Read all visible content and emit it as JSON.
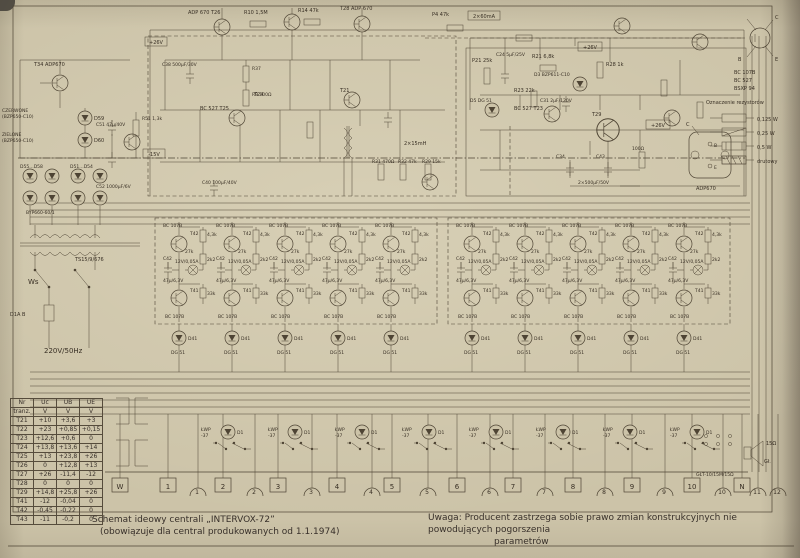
{
  "captions": {
    "title_line1": "Schemat ideowy centrali „INTERVOX-72”",
    "title_line2": "(obowiązuje dla central produkowanych od 1.1.1974)",
    "note_line1": "Uwaga: Producent zastrzega sobie prawo zmian konstrukcyjnych nie powodujących pogorszenia",
    "note_line2": "parametrów"
  },
  "legend": {
    "pin_c": "C",
    "pin_b": "B",
    "pin_e": "E",
    "types": [
      "BC 107B",
      "BC 527",
      "BSXP 94"
    ],
    "title": "Oznaczenie rezystorów",
    "items": [
      "0,125 W",
      "0,25 W",
      "0,5 W",
      "drutowy"
    ],
    "package_label": "ADP670",
    "package_case": "C",
    "package_pin_top": "B",
    "package_pin_bottom": "E"
  },
  "table": {
    "h1": [
      "Nr",
      "Uc",
      "UB",
      "UE"
    ],
    "h2": [
      "tranz.",
      "V",
      "V",
      "V"
    ],
    "rows": [
      [
        "T21",
        "+10",
        "+3,6",
        "+3"
      ],
      [
        "T22",
        "+23",
        "+0,85",
        "+0,15"
      ],
      [
        "T23",
        "+12,6",
        "+0,6",
        "0"
      ],
      [
        "T24",
        "+13,8",
        "+13,6",
        "+14"
      ],
      [
        "T25",
        "+13",
        "+23,8",
        "+26"
      ],
      [
        "T26",
        "0",
        "+12,8",
        "+13"
      ],
      [
        "T27",
        "+26",
        "-11,4",
        "-12"
      ],
      [
        "T28",
        "0",
        "0",
        "0"
      ],
      [
        "T29",
        "+14,8",
        "+25,8",
        "+26"
      ],
      [
        "T41",
        "-12",
        "-0,04",
        "0"
      ],
      [
        "T42",
        "-0,45",
        "-0,22",
        "0"
      ],
      [
        "T43",
        "-11",
        "-0,2",
        "0"
      ]
    ]
  },
  "terminals": {
    "boxes": [
      "W",
      "1",
      "2",
      "3",
      "4",
      "5",
      "6",
      "7",
      "8",
      "9",
      "10",
      "N"
    ],
    "jacks": [
      "1",
      "2",
      "3",
      "4",
      "5",
      "6",
      "7",
      "8",
      "9",
      "10",
      "11",
      "12"
    ]
  },
  "speaker": {
    "impedance": "15Ω",
    "name": "Gł.",
    "type": "GŁT-10/15M/15Ω"
  },
  "channel": {
    "type_top": "BC 107B",
    "t_top": "T42",
    "r1": "4,3k",
    "r2": "2k2",
    "r3": "27k",
    "lamp": "12V/0,05A",
    "c_name": "C42",
    "c_val": "47µ/6,3V",
    "t_bot": "T41",
    "type_bot": "BC 107B",
    "r4": "33k"
  },
  "diode_row": {
    "name": "D41",
    "type": "DG 51"
  },
  "lamp_row": {
    "l1": "ŁWP",
    "l2": "-37",
    "d": "D1"
  },
  "power": {
    "t34": "T34  ADP670",
    "czerwone1": "CZERWONE",
    "czerwone2": "(BZP650-C10)",
    "d59": "D59",
    "zielone1": "ZIELONE",
    "zielone2": "(BZP650-C10)",
    "d60": "D60",
    "d_bridge1": "D55…D58",
    "d_bridge2": "D51…D54",
    "byp": "BYP660-60/1",
    "r51": "R51 1,3k",
    "c51": "C51 47µ/40V",
    "c52": "C52 1000µF/6V",
    "transformer": "TS15/9/676",
    "switch": "Ws",
    "fuse": "D1A B",
    "mains": "220V/50Hz"
  },
  "amp": {
    "t26": "ADP 670   T26",
    "r10": "R10 1,5M",
    "r14": "R14 47k",
    "t28": "T28 ADP 670",
    "p4": "P4 47k",
    "i2x60": "2×60mA",
    "c38": "C38 500µF/30V",
    "r37": "R37",
    "r9": "R9 100Ω",
    "plus26a": "+26V",
    "minus15": "-15V",
    "plus26b": "+26V",
    "t25": "BC 527   T25",
    "t24": "T24",
    "t21": "T21",
    "p21": "P21 25k",
    "c24": "C24 5µF/25V",
    "r21": "R21 6,8k",
    "r28": "R28 1k",
    "d3": "D3 BZP611-C10",
    "r23": "R23 22k",
    "c31": "C31 2µF/120V",
    "t23": "BC 527  T23",
    "d5": "D5 DG 51",
    "ind": "2×15mH",
    "r31": "R31 470Ω",
    "r32": "R32 47k",
    "r29": "R29 15k",
    "t29": "T29",
    "c34": "C34",
    "c43": "C43",
    "caps2x": "2×500µF/50V",
    "r100": "100Ω",
    "c40": "C40 100µF/40V"
  }
}
